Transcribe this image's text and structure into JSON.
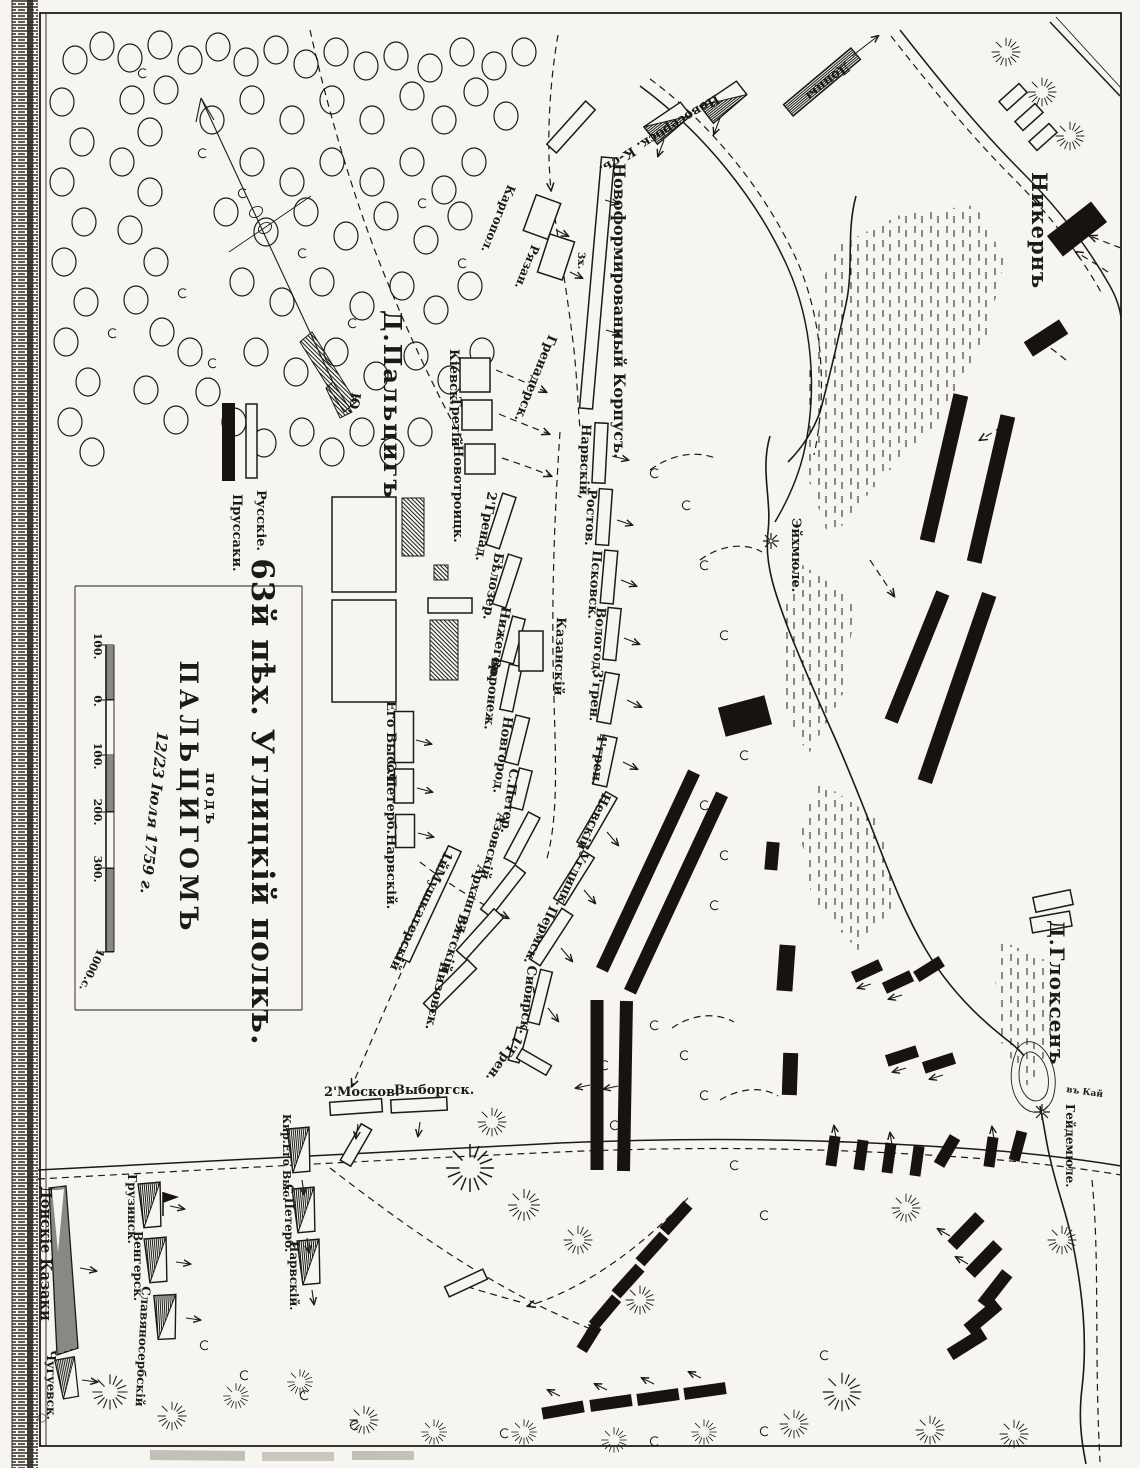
{
  "colors": {
    "ink": "#1c1a17",
    "paper": "#f7f5ef",
    "russian_fill": "#f7f5ef",
    "prussian_fill": "#17140f"
  },
  "title": {
    "regiment": "63й пѣх. Углицкій полкъ.",
    "preposition": "подъ",
    "battle": "ПАЛЬЦИГОМЪ",
    "date": "12/23 Іюля 1759 г."
  },
  "legend": {
    "russians": "Русскіе.",
    "prussians": "Пруссаки."
  },
  "scale": {
    "m100": "100.",
    "zero": "0.",
    "p100": "100.",
    "p200": "200.",
    "p300": "300.",
    "end": "1000.с."
  },
  "compass": {
    "south": "Ю."
  },
  "places": {
    "paltsig": "Д.Пальцигъ",
    "nikern": "Никернъ",
    "eichmuehle": "Эйхмюле.",
    "gloksen": "Д.Глоксенъ",
    "heidemuehle": "Гейдемюле.",
    "kay": "въ Кай"
  },
  "units": {
    "novoserb": "Новосербск. К-съ.",
    "dontsy": "Донцы",
    "novoform": "Новоформированный Корпусъ.",
    "kargopol": "Каргопол.",
    "ryazan": "Рязан.",
    "x3": "3х.",
    "grenadersk": "Гренадерск.",
    "narvsky": "Нарвскій,",
    "rostov": "Ростов.",
    "pskov": "Псковск.",
    "vologod": "Вологод.",
    "gren3": "3'грен.",
    "gren4": "4'грен.",
    "nevsky": "Невскій",
    "uglitsk": "Углицк.",
    "permsk": "Пермск.",
    "sibirsk": "Сибирск.",
    "gren1": "1'Грен.",
    "kazan": "Казанскій",
    "kievsk": "Кіевск.",
    "tretiy": "Третій",
    "novotroitsk": "Новотроицк.",
    "grenad2": "2'Гренад.",
    "belozer": "Бѣлозер.",
    "nizhegor": "Нижегор.",
    "voronezh": "Воронеж.",
    "novgorod": "Новгород.",
    "spb1": "С.Петер.",
    "azov": "Азовскій",
    "arkhangel": "Архангел.",
    "vyatsk": "Вятскій",
    "nizovsk": "Низовск.",
    "egovysoch": "Его Высоч.",
    "spb_narv": "С.Петерб.Нарвскій.",
    "mushkater": "1йМушкатерскій",
    "moskov2": "2'Москов.",
    "vyborg": "Выборгск.",
    "kirg": "Кир.Его Выс.",
    "spb2": "С.Петерб.",
    "narv2": "Нарвскій.",
    "don_kazaki": "Донскіе Казаки",
    "chuguev": "Чугуевск.",
    "gruzinsk": "Грузинск.",
    "vengersk": "Венгерск.",
    "slavyanoserb": "Славяносербскій"
  }
}
